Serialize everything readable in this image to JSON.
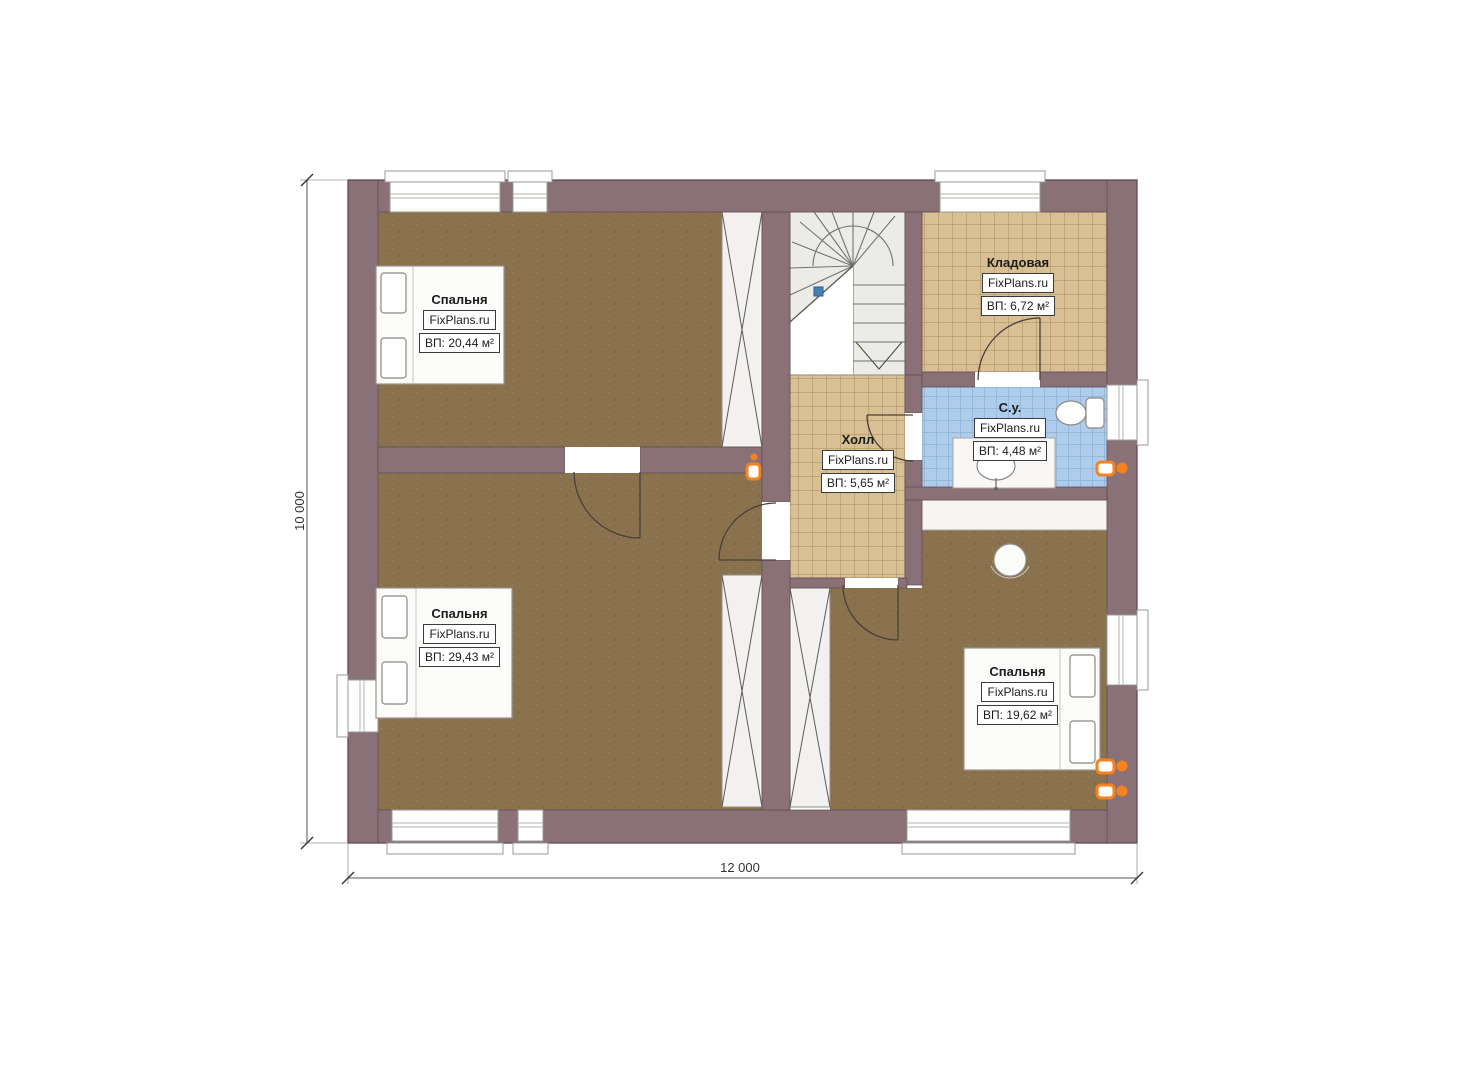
{
  "plan": {
    "dimensions": {
      "height_label": "10 000",
      "width_label": "12 000"
    },
    "rooms": [
      {
        "id": "bedroom-top-left",
        "name": "Спальня",
        "brand": "FixPlans.ru",
        "area": "ВП: 20,44 м²"
      },
      {
        "id": "bedroom-bottom-left",
        "name": "Спальня",
        "brand": "FixPlans.ru",
        "area": "ВП: 29,43 м²"
      },
      {
        "id": "bedroom-right",
        "name": "Спальня",
        "brand": "FixPlans.ru",
        "area": "ВП: 19,62 м²"
      },
      {
        "id": "storeroom",
        "name": "Кладовая",
        "brand": "FixPlans.ru",
        "area": "ВП: 6,72 м²"
      },
      {
        "id": "hall",
        "name": "Холл",
        "brand": "FixPlans.ru",
        "area": "ВП: 5,65 м²"
      },
      {
        "id": "bathroom",
        "name": "С.у.",
        "brand": "FixPlans.ru",
        "area": "ВП: 4,48 м²"
      }
    ],
    "colors": {
      "wall": "#8a7077",
      "wall_outline": "#5e4b50",
      "floor_bedroom": "#8b724f",
      "tile_storeroom": "#d9bf94",
      "tile_grout_tan": "#a98c5f",
      "tile_bathroom": "#aecdec",
      "tile_grout_blue": "#7fa3c8",
      "shaft_bg": "#f2f1ef",
      "stair_bg": "#ebebe8",
      "line_dark": "#4a4038",
      "accent_radiator": "#f5821e",
      "marker_blue": "#4a7fb5",
      "dimension_text": "#333333"
    }
  }
}
